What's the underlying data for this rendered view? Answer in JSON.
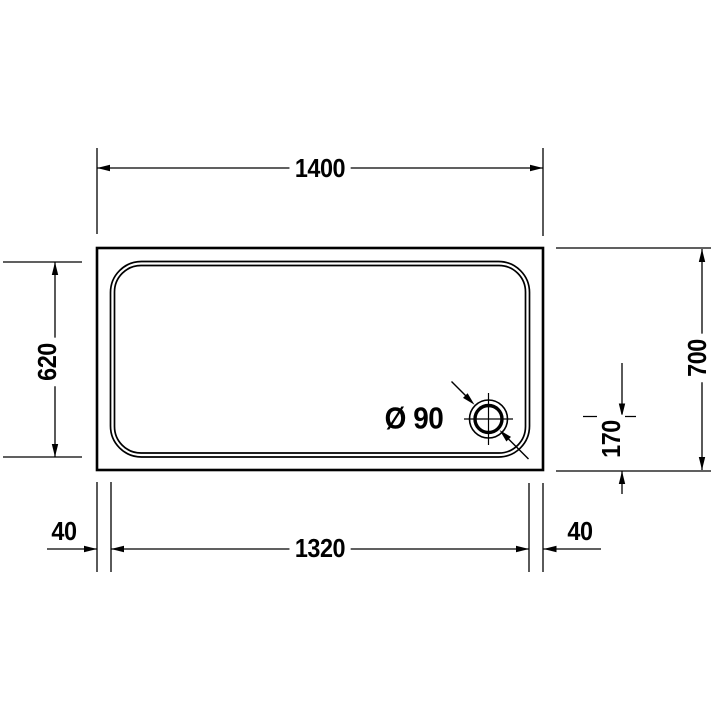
{
  "page": {
    "background_color": "#ffffff",
    "line_color": "#000000"
  },
  "drawing": {
    "labels": {
      "top_width": "1400",
      "left_height": "620",
      "right_height": "700",
      "drain_offset": "170",
      "rim_left": "40",
      "bottom_width": "1320",
      "rim_right": "40",
      "drain_diameter": "Ø 90"
    }
  }
}
